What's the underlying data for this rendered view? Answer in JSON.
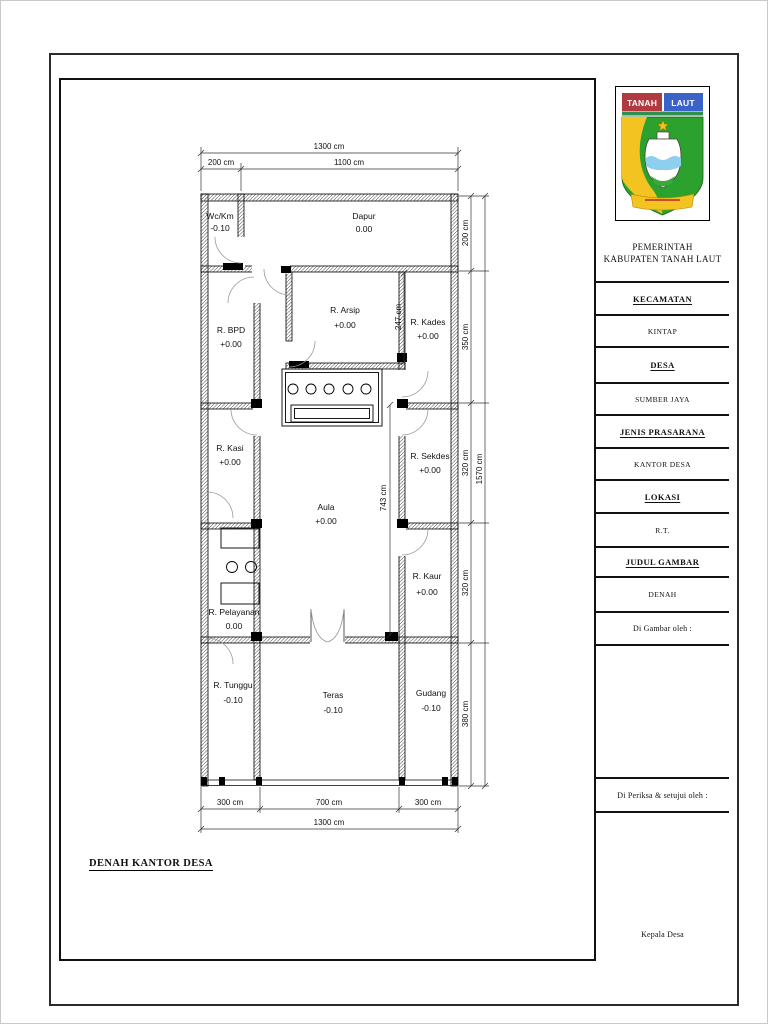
{
  "page": {
    "drawing_label": "DENAH KANTOR DESA"
  },
  "logo": {
    "left": "TANAH",
    "right": "LAUT"
  },
  "title_block": {
    "agency_line1": "PEMERINTAH",
    "agency_line2": "KABUPATEN TANAH LAUT",
    "kecamatan_label": "KECAMATAN",
    "kecamatan_value": "KINTAP",
    "desa_label": "DESA",
    "desa_value": "SUMBER JAYA",
    "jenis_label": "JENIS PRASARANA",
    "jenis_value": "KANTOR DESA",
    "lokasi_label": "LOKASI",
    "lokasi_value": "R.T.",
    "judul_label": "JUDUL GAMBAR",
    "judul_value": "DENAH",
    "drawn_by_label": "Di Gambar oleh :",
    "checked_by_label": "Di Periksa & setujui oleh :",
    "signer_title": "Kepala Desa"
  },
  "floor_plan": {
    "rooms": [
      {
        "name": "Wc/Km",
        "level": "-0.10"
      },
      {
        "name": "Dapur",
        "level": "0.00"
      },
      {
        "name": "R. BPD",
        "level": "+0.00"
      },
      {
        "name": "R. Arsip",
        "level": "+0.00"
      },
      {
        "name": "R. Kades",
        "level": "+0.00"
      },
      {
        "name": "R. Kasi",
        "level": "+0.00"
      },
      {
        "name": "Aula",
        "level": "+0.00"
      },
      {
        "name": "R. Sekdes",
        "level": "+0.00"
      },
      {
        "name": "R. Kaur",
        "level": "+0.00"
      },
      {
        "name": "R. Pelayanan",
        "level": "0.00"
      },
      {
        "name": "R. Tunggu",
        "level": "-0.10"
      },
      {
        "name": "Teras",
        "level": "-0.10"
      },
      {
        "name": "Gudang",
        "level": "-0.10"
      }
    ],
    "dims": {
      "top_overall": "1300 cm",
      "top_left": "200 cm",
      "top_right": "1100 cm",
      "right_1": "200 cm",
      "right_2": "350 cm",
      "right_3": "320 cm",
      "right_4": "320 cm",
      "right_5": "380 cm",
      "right_overall": "1570 cm",
      "bottom_left": "300 cm",
      "bottom_mid": "700 cm",
      "bottom_right": "300 cm",
      "bottom_overall": "1300 cm",
      "aula_height": "743 cm",
      "arsip_wall": "247 cm"
    }
  }
}
